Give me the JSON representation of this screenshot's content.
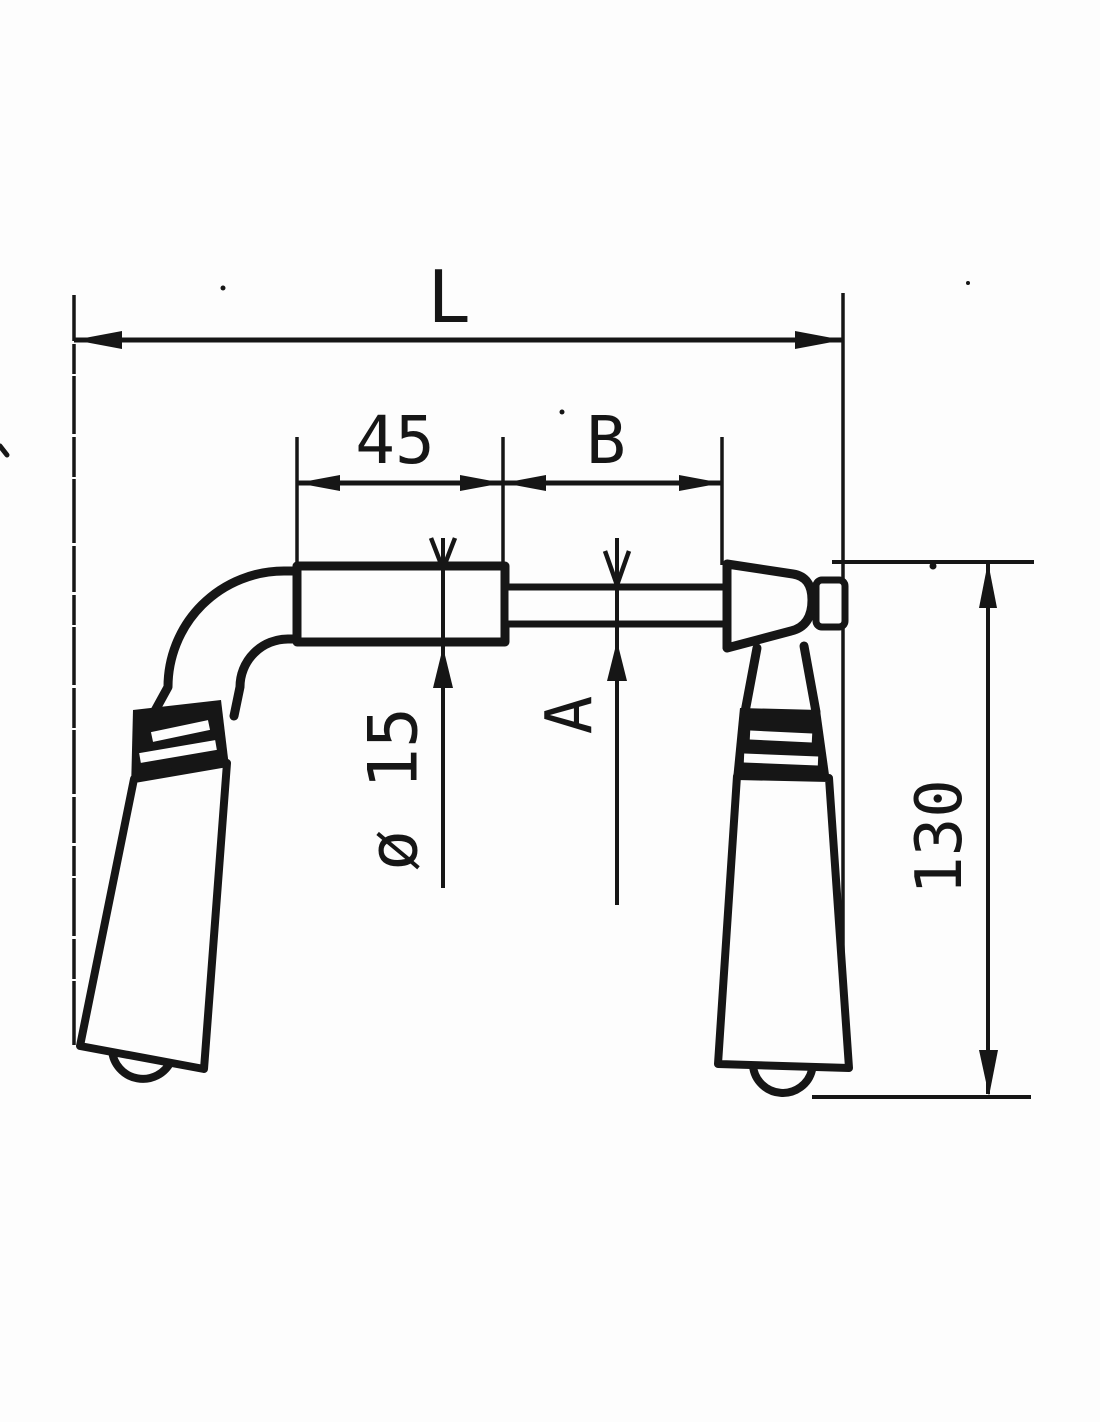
{
  "figure": {
    "background_color": "#fdfdfd",
    "ink_color": "#161616",
    "dimension_labels": {
      "overall_length": "L",
      "left_segment": "45",
      "right_segment": "B",
      "tube_diameter": "ø 15",
      "spindle_size": "A",
      "handle_height": "130"
    }
  }
}
